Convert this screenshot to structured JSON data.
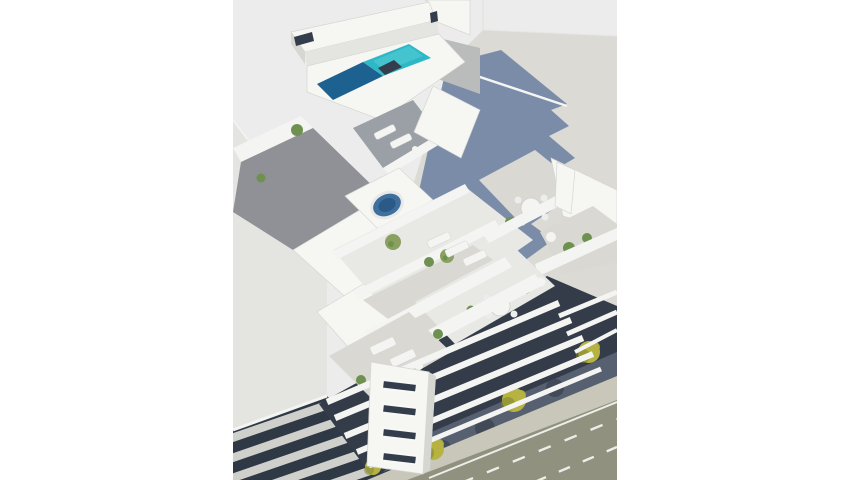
{
  "scene": {
    "type": "architectural-3d-render",
    "description": "Aerial 3D architectural render of a modern white apartment building with a rooftop swimming pool (turquoise and deep blue), a jacuzzi terrace, sun loungers, round terrace tables with chairs, potted plants, stepped balconies with white rails, a stair core with slot windows, neighbouring flat-roof buildings (one receiving a stepped blue cast shadow), a striped balcony facade at lower left, and a street at lower right with white lane markings and small yellow-green trees along the sidewalk.",
    "elements": [
      "rooftop-pool",
      "jacuzzi",
      "sun-loungers",
      "terrace-round-tables",
      "potted-plants",
      "balcony-rails",
      "stair-core-slot-windows",
      "street-lane-markings",
      "sidewalk-trees",
      "cast-shadow-on-roof",
      "neighbor-roof",
      "striped-balcony-facade"
    ]
  },
  "colors": {
    "canvas": "#ffffff",
    "render_bg": "#ebeceb",
    "neighbor_roof": "#dbdad5",
    "shadow_blue": "#7285a3",
    "plane_light": "#e4e4e1",
    "stripe_dark": "#2f3945",
    "stripe_light": "#cfcfcb",
    "dark_facade": "#333c48",
    "shadow_zone": "#596273",
    "tree_shadow": "#3e4754",
    "sidewalk": "#c8c7ba",
    "street": "#90927f",
    "marking": "#edeee9",
    "tree": "#b6b342",
    "tree_dark": "#7e8430",
    "plant": "#6f9150",
    "plant_light": "#8aa060",
    "building_white": "#f6f6f3",
    "face_shade": "#d6d6d3",
    "slot_dark": "#333d4b",
    "deck_gray": "#8f9196",
    "deck_blue": "#9aa0a5",
    "deck_light": "#d9d8d3",
    "terrace_light": "#e8e8e4",
    "pool_teal": "#2eb8c5",
    "pool_teal_light": "#55cdd6",
    "pool_deep": "#1d6190",
    "jacuzzi": "#3f6f9e",
    "jacuzzi_deep": "#2c5a86",
    "gray_roof": "#b9bcba",
    "rail_white": "#f4f4f2",
    "chair": "#eceded"
  }
}
